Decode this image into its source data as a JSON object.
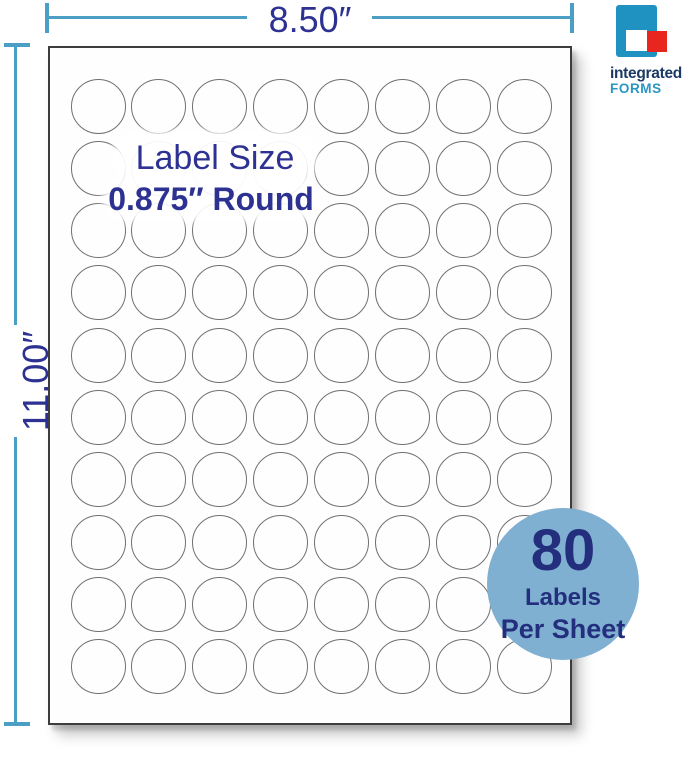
{
  "top_dimension": {
    "label": "8.50″"
  },
  "left_dimension": {
    "label": "11.00″"
  },
  "sheet": {
    "title": "Label Size",
    "subtitle": "0.875″ Round",
    "grid": {
      "rows": 10,
      "cols": 8,
      "total_labels": 80
    }
  },
  "badge": {
    "number": "80",
    "line1": "Labels",
    "line2": "Per Sheet"
  },
  "logo": {
    "line1": "integrated",
    "line2": "FORMS"
  },
  "colors": {
    "dimension_line": "#4B9FC4",
    "navy_text": "#2D3192",
    "badge_bg": "#7FB0D2",
    "badge_text": "#232E7D",
    "logo_teal": "#2092C2",
    "logo_teal_text": "#2A96C2",
    "logo_red": "#E8251F",
    "logo_navy": "#1B3A66",
    "circle_stroke": "#6F7074",
    "sheet_border": "#3D3D3F"
  }
}
